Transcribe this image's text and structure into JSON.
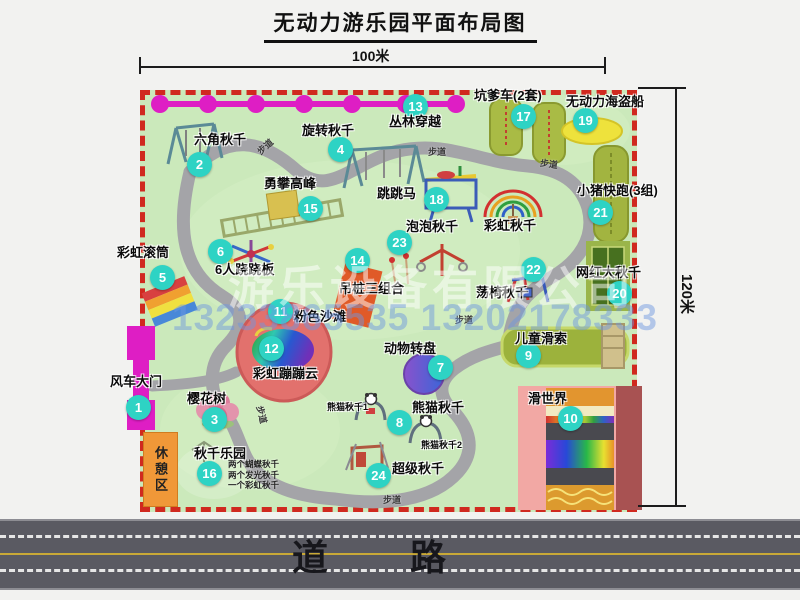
{
  "title": "无动力游乐园平面布局图",
  "dim_width": "100米",
  "dim_height": "120米",
  "road_label": "道 路",
  "rest_area_label": "休憩区",
  "walkway_text": "步道",
  "watermark": {
    "company": "游乐设备有限公司",
    "phone": "13233865535 13202178333"
  },
  "colors": {
    "badge": "#2ed3c4",
    "border-red": "#d0291f",
    "map-green": "#cbe9bb",
    "magenta": "#de1ec4",
    "road-gray": "#5a5a62",
    "rest-orange": "#f09838"
  },
  "attractions": [
    {
      "num": "1",
      "name": "风车大门",
      "badge": [
        139,
        408
      ],
      "label": [
        110,
        375
      ]
    },
    {
      "num": "2",
      "name": "六角秋千",
      "badge": [
        200,
        165
      ],
      "label": [
        194,
        133
      ]
    },
    {
      "num": "3",
      "name": "樱花树",
      "badge": [
        215,
        420
      ],
      "label": [
        187,
        392
      ]
    },
    {
      "num": "4",
      "name": "旋转秋千",
      "badge": [
        341,
        150
      ],
      "label": [
        302,
        124
      ]
    },
    {
      "num": "5",
      "name": "彩虹滚筒",
      "badge": [
        163,
        278
      ],
      "label": [
        117,
        246
      ]
    },
    {
      "num": "6",
      "name": "6人跷跷板",
      "badge": [
        221,
        252
      ],
      "label": [
        215,
        263
      ]
    },
    {
      "num": "7",
      "name": "动物转盘",
      "badge": [
        441,
        368
      ],
      "label": [
        384,
        342
      ]
    },
    {
      "num": "8",
      "name": "熊猫秋千",
      "badge": [
        400,
        423
      ],
      "label": [
        412,
        401
      ]
    },
    {
      "num": "9",
      "name": "儿童滑索",
      "badge": [
        529,
        356
      ],
      "label": [
        515,
        332
      ]
    },
    {
      "num": "10",
      "name": "滑世界",
      "badge": [
        571,
        419
      ],
      "label": [
        528,
        392
      ]
    },
    {
      "num": "11",
      "name": "粉色沙滩",
      "badge": [
        281,
        312
      ],
      "label": [
        294,
        310
      ]
    },
    {
      "num": "12",
      "name": "彩虹蹦蹦云",
      "badge": [
        272,
        349
      ],
      "label": [
        253,
        367
      ]
    },
    {
      "num": "13",
      "name": "丛林穿越",
      "badge": [
        416,
        107
      ],
      "label": [
        389,
        115
      ]
    },
    {
      "num": "14",
      "name": "吊桩三组合",
      "badge": [
        358,
        261
      ],
      "label": [
        339,
        282
      ]
    },
    {
      "num": "15",
      "name": "勇攀高峰",
      "badge": [
        311,
        209
      ],
      "label": [
        264,
        177
      ]
    },
    {
      "num": "16",
      "name": "秋千乐园",
      "badge": [
        210,
        474
      ],
      "label": [
        194,
        447
      ]
    },
    {
      "num": "17",
      "name": "坑爹车(2套)",
      "badge": [
        524,
        117
      ],
      "label": [
        474,
        89
      ]
    },
    {
      "num": "18",
      "name": "跳跳马",
      "badge": [
        437,
        200
      ],
      "label": [
        377,
        187
      ]
    },
    {
      "num": "19",
      "name": "无动力海盗船",
      "badge": [
        586,
        121
      ],
      "label": [
        566,
        95
      ]
    },
    {
      "num": "20",
      "name": "网红大秋千",
      "badge": [
        620,
        294
      ],
      "label": [
        576,
        266
      ]
    },
    {
      "num": "21",
      "name": "小猪快跑(3组)",
      "badge": [
        601,
        213
      ],
      "label": [
        577,
        184
      ]
    },
    {
      "num": "22",
      "name": "荡椅秋千",
      "badge": [
        534,
        270
      ],
      "label": [
        476,
        286
      ]
    },
    {
      "num": "23",
      "name": "泡泡秋千",
      "badge": [
        400,
        243
      ],
      "label": [
        406,
        220
      ]
    },
    {
      "num": "24",
      "name": "超级秋千",
      "badge": [
        379,
        476
      ],
      "label": [
        392,
        462
      ]
    }
  ],
  "extra_labels": [
    {
      "text": "彩虹秋千",
      "x": 484,
      "y": 219,
      "small": false
    },
    {
      "text": "熊猫秋千1",
      "x": 327,
      "y": 403,
      "small": true
    },
    {
      "text": "熊猫秋千2",
      "x": 421,
      "y": 441,
      "small": true
    }
  ],
  "swing_details": [
    "两个蝴蝶秋千",
    "两个发光秋千",
    "一个彩虹秋千"
  ],
  "walkway_labels": [
    {
      "x": 256,
      "y": 140,
      "r": -42
    },
    {
      "x": 428,
      "y": 145,
      "r": 0
    },
    {
      "x": 540,
      "y": 157,
      "r": 8
    },
    {
      "x": 455,
      "y": 313,
      "r": 0
    },
    {
      "x": 253,
      "y": 408,
      "r": 76
    },
    {
      "x": 383,
      "y": 493,
      "r": 0
    }
  ]
}
